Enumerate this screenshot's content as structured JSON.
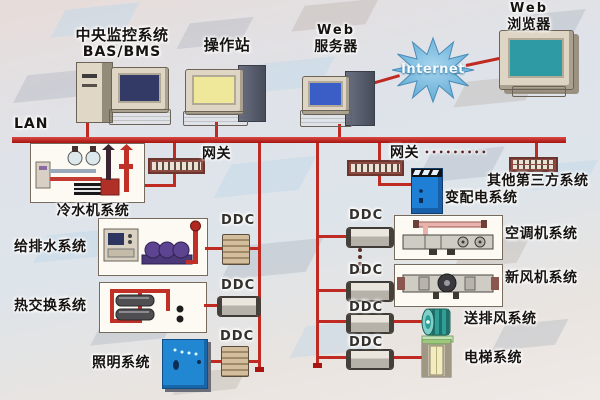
{
  "diagram": {
    "top": {
      "central_station": {
        "line1": "中央监控系统",
        "line2": "BAS/BMS"
      },
      "operator_station": {
        "label": "操作站"
      },
      "web_server": {
        "line1": "Web",
        "line2": "服务器"
      },
      "internet": {
        "label": "Internet"
      },
      "web_browser": {
        "line1": "Web",
        "line2": "浏览器"
      }
    },
    "lan": {
      "label": "LAN"
    },
    "gateways": {
      "left": {
        "label": "网关"
      },
      "right": {
        "label": "网关",
        "dots": "•••••••••"
      },
      "third_party": {
        "label": "其他第三方系统"
      }
    },
    "ddc_label": "DDC",
    "left_branch": {
      "chiller": {
        "label": "冷水机系统"
      },
      "water_supply": {
        "label": "给排水系统"
      },
      "heat_exchange": {
        "label": "热交换系统"
      },
      "lighting": {
        "label": "照明系统"
      }
    },
    "right_branch": {
      "power_distribution": {
        "label": "变配电系统"
      },
      "air_conditioning": {
        "label": "空调机系统"
      },
      "fresh_air": {
        "label": "新风机系统"
      },
      "exhaust_fan": {
        "label": "送排风系统"
      },
      "elevator": {
        "label": "电梯系统"
      }
    },
    "colors": {
      "network_line": "#bf2b23",
      "lan_bus": "#b01812",
      "panel_blue": "#2187d2",
      "internet_blue": "#5aa8d4",
      "screen_yellow": "#efe79a",
      "screen_navy": "#333a66",
      "screen_blue": "#3b5ec6",
      "screen_teal": "#2d9aa4"
    }
  }
}
